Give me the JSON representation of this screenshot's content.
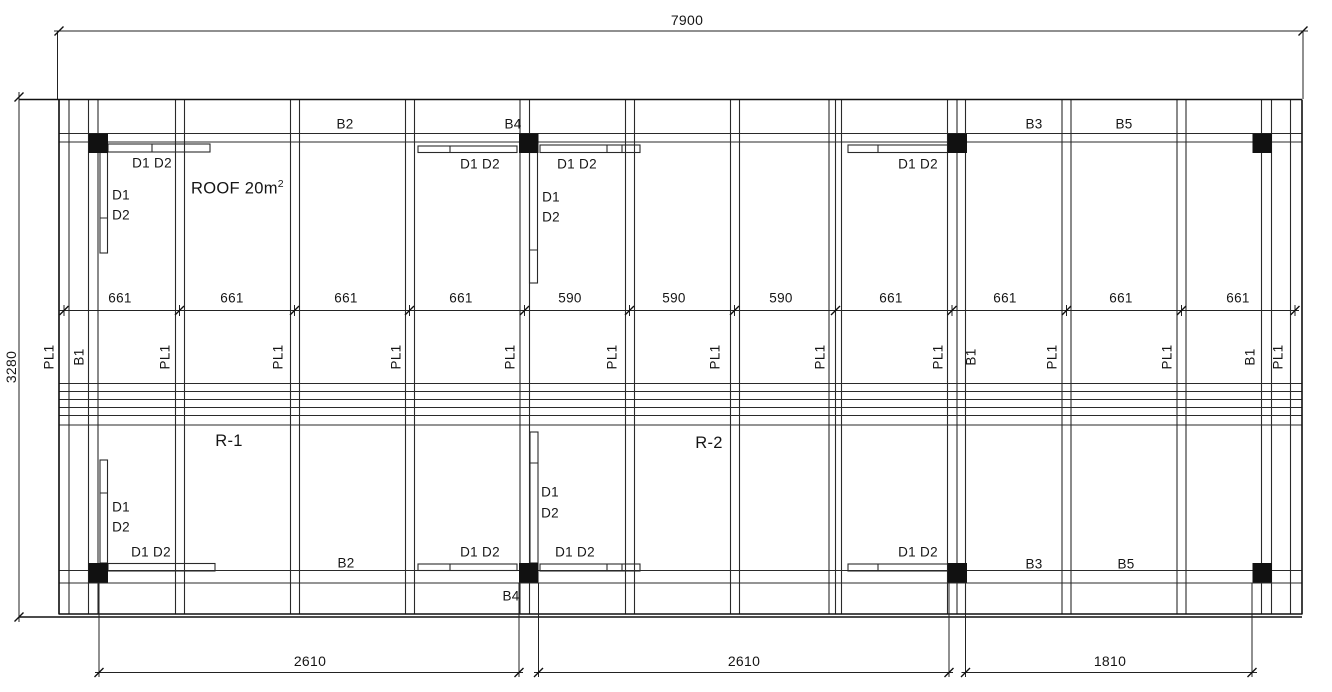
{
  "drawing": {
    "overall": {
      "width": "7900",
      "height": "3280"
    },
    "bottom_dims": [
      "2610",
      "2610",
      "1810"
    ],
    "spacing_dims": [
      "661",
      "661",
      "661",
      "661",
      "590",
      "590",
      "590",
      "661",
      "661",
      "661",
      "661"
    ],
    "plates": [
      "PL1",
      "B1",
      "PL1",
      "PL1",
      "PL1",
      "PL1",
      "PL1",
      "PL1",
      "PL1",
      "PL1",
      "B1",
      "PL1",
      "PL1",
      "B1",
      "PL1"
    ],
    "beams": {
      "b2": "B2",
      "b3": "B3",
      "b4": "B4",
      "b5": "B5"
    },
    "areas": {
      "roof_text": "ROOF 20m",
      "roof_sup": "2",
      "r1": "R-1",
      "r2": "R-2"
    },
    "joists": {
      "d1": "D1",
      "d2": "D2",
      "d1d2": "D1 D2"
    }
  }
}
